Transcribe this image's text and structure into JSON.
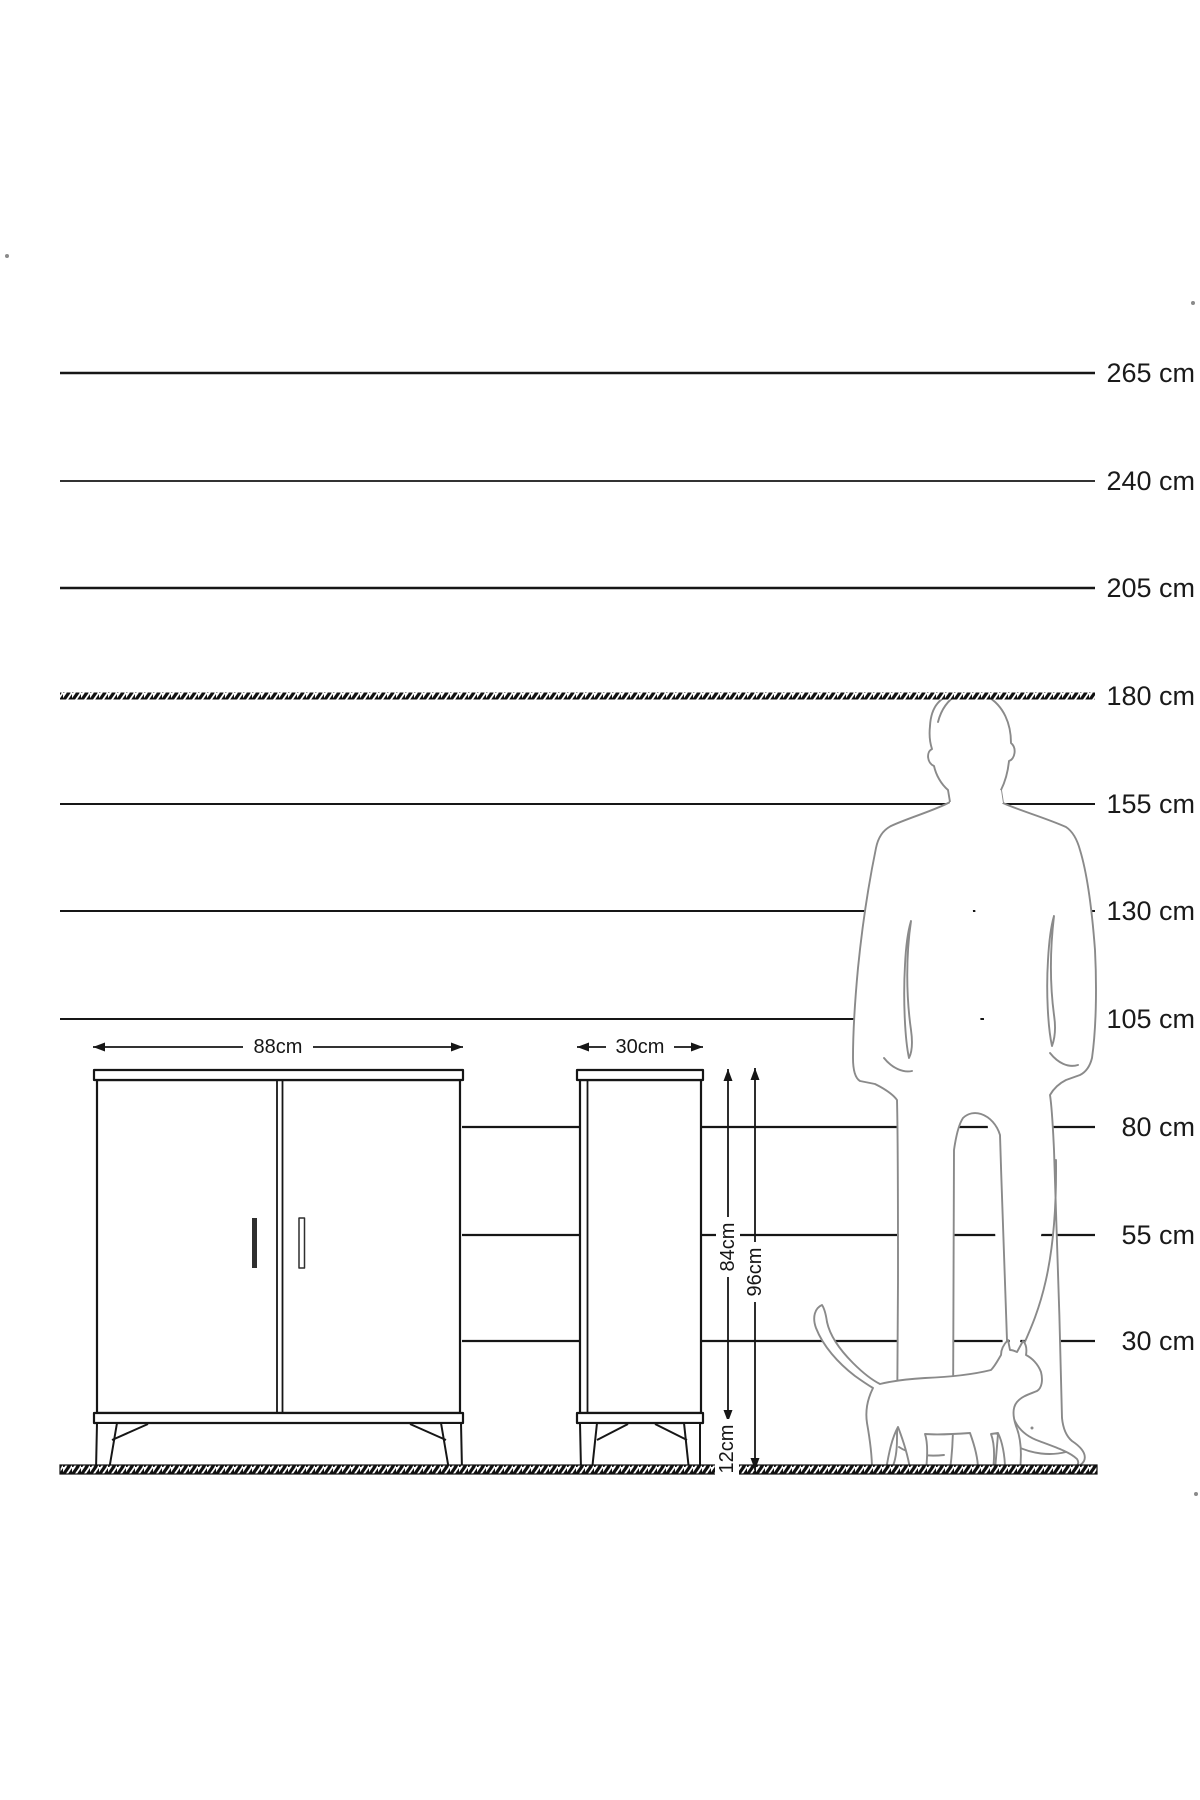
{
  "diagram": {
    "type": "furniture-dimension-diagram",
    "unit": "cm",
    "height_scale": {
      "labels": [
        "265 cm",
        "240 cm",
        "205 cm",
        "180 cm",
        "155 cm",
        "130 cm",
        "105 cm",
        "80 cm",
        "55 cm",
        "30 cm"
      ],
      "values_cm": [
        265,
        240,
        205,
        180,
        155,
        130,
        105,
        80,
        55,
        30
      ],
      "highlighted_value_cm": 180,
      "highlight_style": "hatched-line"
    },
    "cabinet_front_view": {
      "width_label": "88cm",
      "doors": 2,
      "handles": 2
    },
    "cabinet_side_view": {
      "depth_label": "30cm",
      "body_height_label": "84cm",
      "total_height_label": "96cm",
      "leg_height_label": "12cm"
    },
    "figures": {
      "man": "standing man silhouette (reaches 180 cm line)",
      "cat": "walking cat silhouette"
    },
    "colors": {
      "ink": "#161616",
      "text": "#1a1a1a",
      "silhouette_outline": "#8a8a8a",
      "background": "#ffffff"
    }
  }
}
